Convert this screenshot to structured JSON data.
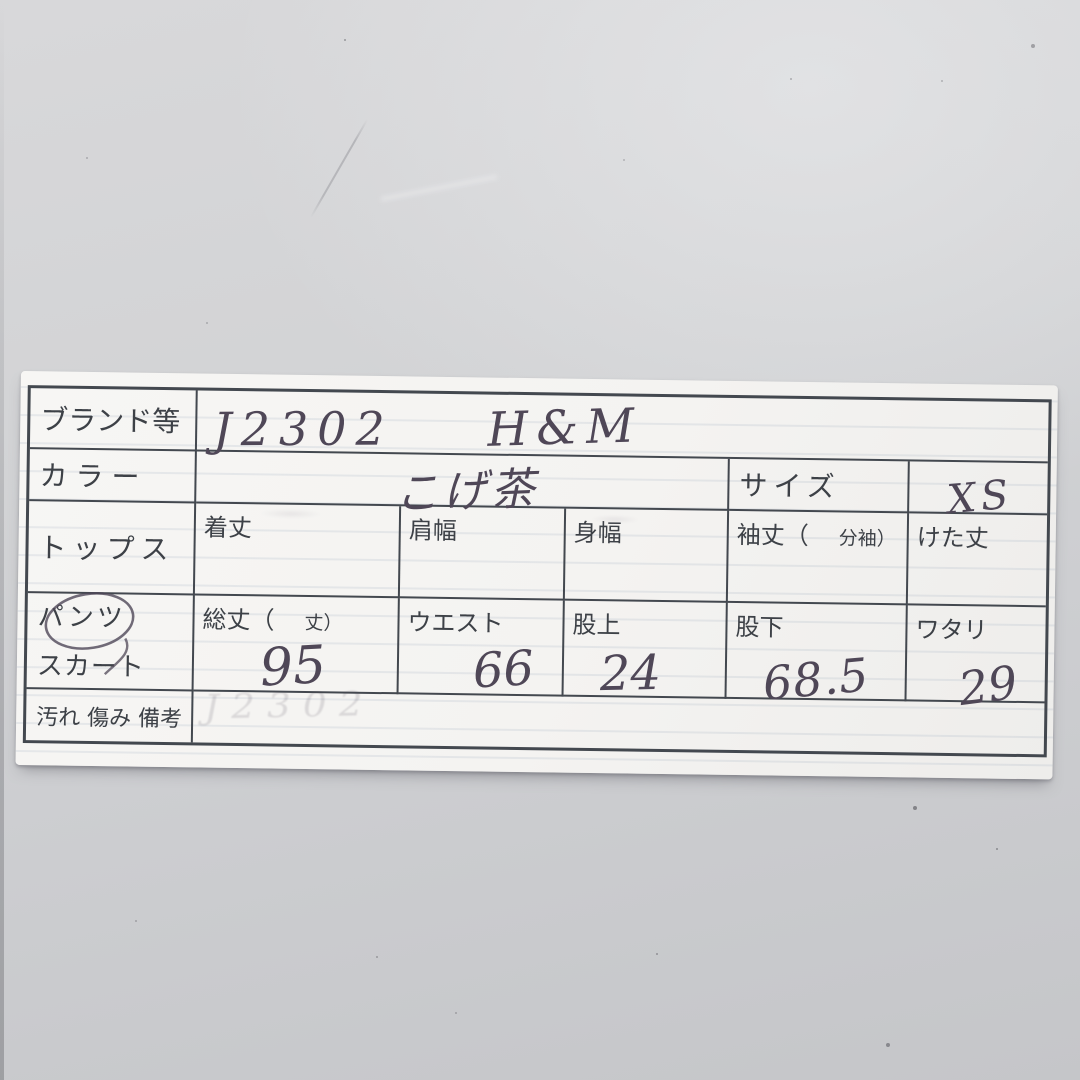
{
  "card": {
    "brand_row": {
      "label": "ブランド等",
      "code": "J2302",
      "name": "H&M"
    },
    "color_row": {
      "label": "カラー",
      "value": "こげ茶"
    },
    "size": {
      "label": "サイズ",
      "value": "XS"
    },
    "tops_row": {
      "label": "トップス",
      "cells": [
        {
          "main": "着丈",
          "paren": "",
          "value": ""
        },
        {
          "main": "肩幅",
          "paren": "",
          "value": ""
        },
        {
          "main": "身幅",
          "paren": "",
          "value": ""
        },
        {
          "main": "袖丈（",
          "paren": "分袖）",
          "value": ""
        },
        {
          "main": "けた丈",
          "paren": "",
          "value": ""
        }
      ]
    },
    "bottoms_row": {
      "label_line1": "パンツ",
      "label_line2": "スカート",
      "circled_option": "パンツ",
      "cells": [
        {
          "main": "総丈（",
          "paren": "丈）",
          "value": "95"
        },
        {
          "main": "ウエスト",
          "paren": "",
          "value": "66"
        },
        {
          "main": "股上",
          "paren": "",
          "value": "24"
        },
        {
          "main": "股下",
          "paren": "",
          "value": "68.5"
        },
        {
          "main": "ワタリ",
          "paren": "",
          "value": "29"
        }
      ]
    },
    "notes_row": {
      "label": "汚れ 傷み 備考",
      "ghost_value": "J2302"
    },
    "colors": {
      "ink": "#4f4757",
      "printed": "#3d4147",
      "table_line": "#43484f",
      "paper": "#f4f3f1",
      "background": "#d2d3d5"
    }
  }
}
